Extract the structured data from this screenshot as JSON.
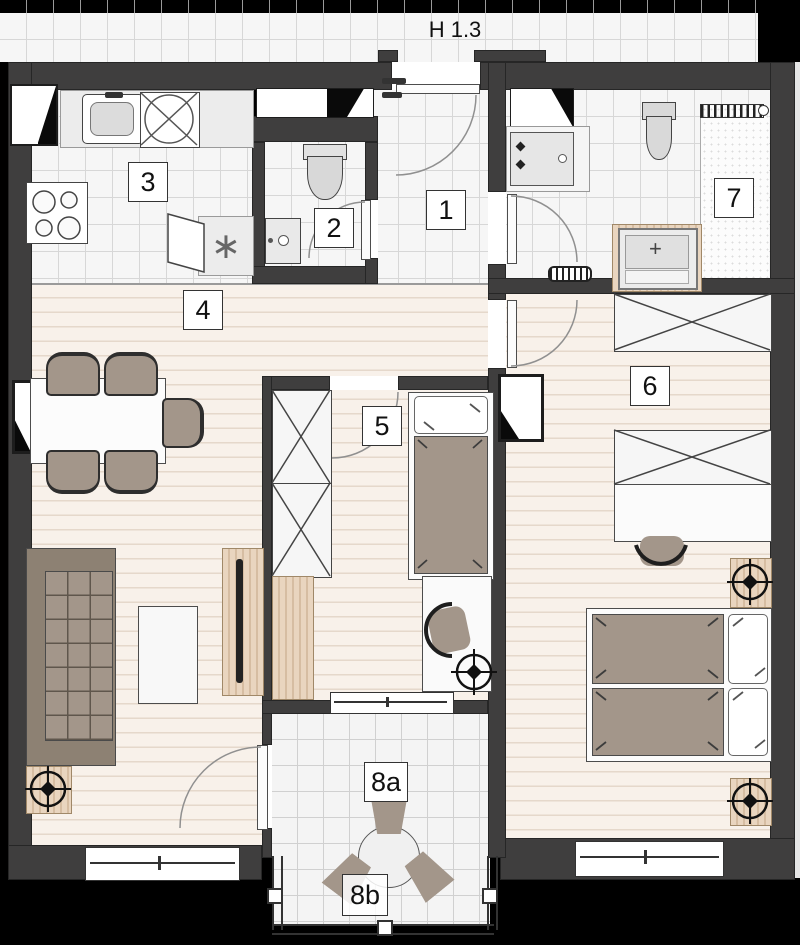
{
  "floorplan": {
    "corridor_label": "H 1.3",
    "rooms": {
      "hall": {
        "label": "1",
        "type": "entrance-hall"
      },
      "wc": {
        "label": "2",
        "type": "wc"
      },
      "kitchen": {
        "label": "3",
        "type": "kitchen"
      },
      "living": {
        "label": "4",
        "type": "living-dining"
      },
      "kids": {
        "label": "5",
        "type": "bedroom-small"
      },
      "bedroom": {
        "label": "6",
        "type": "bedroom-master"
      },
      "bath": {
        "label": "7",
        "type": "bathroom"
      },
      "loggia_inner": {
        "label": "8a",
        "type": "loggia"
      },
      "loggia_outer": {
        "label": "8b",
        "type": "loggia"
      }
    },
    "symbols": {
      "kitchen_appliance_mark": "∗",
      "tub_mark": "+"
    },
    "colors": {
      "wall": "#3f3e3e",
      "outside": "#000000",
      "tile_floor": "#f6f6f6",
      "wood_floor": "#f8f1ea",
      "furniture_brown": "#a3968a",
      "wood_texture": "#e0c7ab",
      "sofa": "#8d8173"
    }
  }
}
